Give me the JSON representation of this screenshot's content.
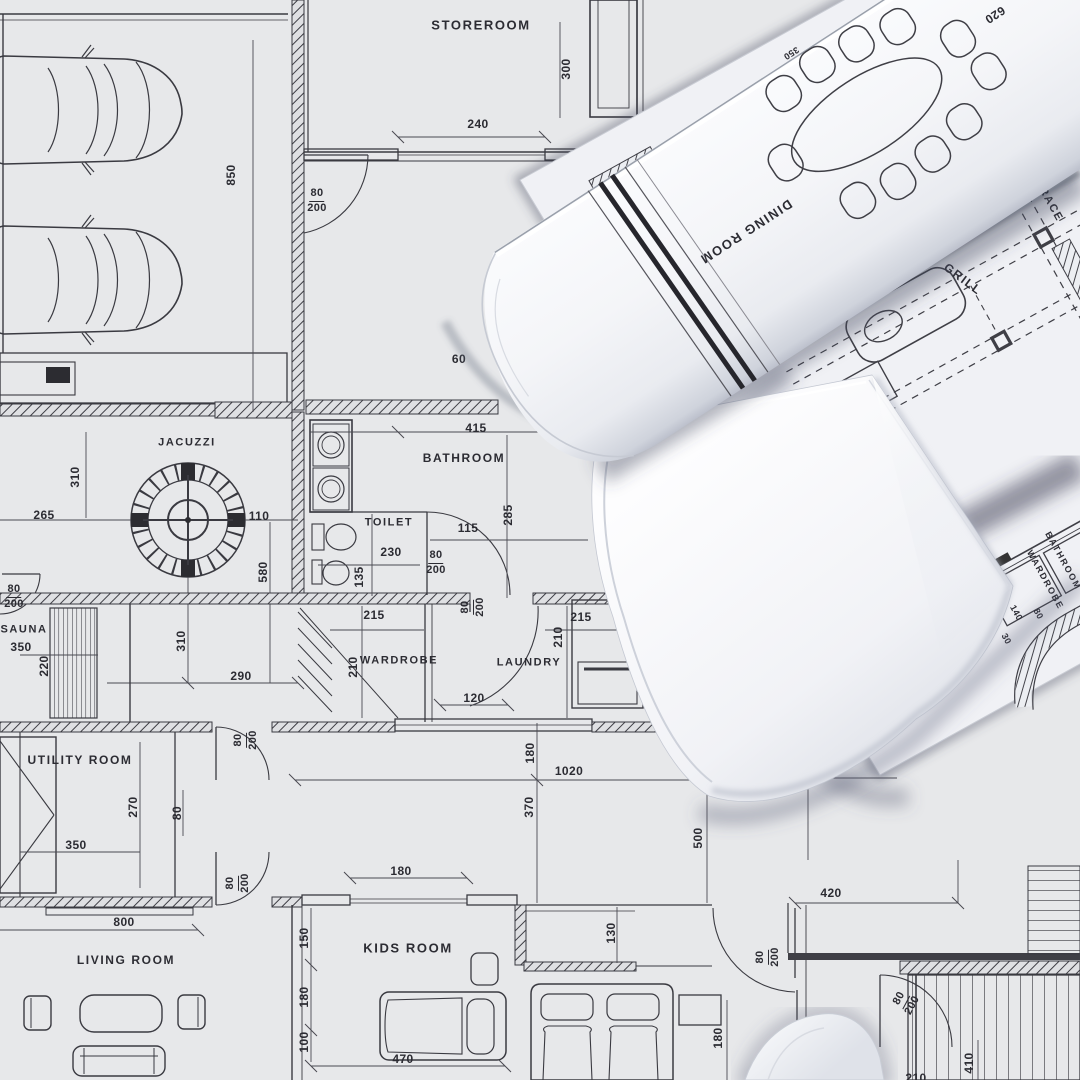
{
  "scene": {
    "description": "Architectural floor plan blueprint with rolled-up drawings lying on top",
    "palette": {
      "paper": "#e7e8ea",
      "roll_paper": "#f7f8fb",
      "ink": "#3a3a41",
      "dim_ink": "#44444b",
      "shadow": "#6b7088"
    }
  },
  "labels": [
    {
      "text": "STOREROOM",
      "kind": "room",
      "x": 481,
      "y": 25,
      "rot": 0,
      "size": 13,
      "layer": "base"
    },
    {
      "text": "JACUZZI",
      "kind": "room",
      "x": 187,
      "y": 443,
      "rot": 0,
      "size": 11,
      "layer": "base"
    },
    {
      "text": "BATHROOM",
      "kind": "room",
      "x": 464,
      "y": 458,
      "rot": 0,
      "size": 12,
      "layer": "base"
    },
    {
      "text": "TOILET",
      "kind": "room",
      "x": 389,
      "y": 523,
      "rot": 0,
      "size": 11,
      "layer": "base"
    },
    {
      "text": "SAUNA",
      "kind": "room",
      "x": 24,
      "y": 630,
      "rot": 0,
      "size": 11,
      "layer": "base"
    },
    {
      "text": "WARDROBE",
      "kind": "room",
      "x": 399,
      "y": 661,
      "rot": 0,
      "size": 11,
      "layer": "base"
    },
    {
      "text": "LAUNDRY",
      "kind": "room",
      "x": 529,
      "y": 663,
      "rot": 0,
      "size": 11,
      "layer": "base"
    },
    {
      "text": "UTILITY ROOM",
      "kind": "room",
      "x": 80,
      "y": 760,
      "rot": 0,
      "size": 12,
      "layer": "base"
    },
    {
      "text": "KIDS ROOM",
      "kind": "room",
      "x": 408,
      "y": 948,
      "rot": 0,
      "size": 13,
      "layer": "base"
    },
    {
      "text": "LIVING ROOM",
      "kind": "room",
      "x": 126,
      "y": 960,
      "rot": 0,
      "size": 12,
      "layer": "base"
    },
    {
      "text": "DINING ROOM",
      "kind": "room",
      "x": 746,
      "y": 232,
      "rot": 147,
      "size": 13,
      "layer": "roll"
    },
    {
      "text": "TERRACE",
      "kind": "room",
      "x": 1044,
      "y": 193,
      "rot": 61,
      "size": 11,
      "layer": "sheet2"
    },
    {
      "text": "GRILL",
      "kind": "room",
      "x": 963,
      "y": 279,
      "rot": 37,
      "size": 12,
      "layer": "sheet2"
    },
    {
      "text": "BATHROOM",
      "kind": "room",
      "x": 1063,
      "y": 561,
      "rot": 61,
      "size": 9,
      "layer": "sheet2"
    },
    {
      "text": "WARDROBE",
      "kind": "room",
      "x": 1045,
      "y": 580,
      "rot": 61,
      "size": 9,
      "layer": "sheet2"
    },
    {
      "text": "850",
      "kind": "dim",
      "x": 231,
      "y": 175,
      "rot": -90,
      "size": 12,
      "layer": "base"
    },
    {
      "text": "300",
      "kind": "dim",
      "x": 566,
      "y": 69,
      "rot": -90,
      "size": 12,
      "layer": "base"
    },
    {
      "text": "240",
      "kind": "dim",
      "x": 478,
      "y": 124,
      "rot": 0,
      "size": 12,
      "layer": "base"
    },
    {
      "text": "265",
      "kind": "dim",
      "x": 44,
      "y": 515,
      "rot": 0,
      "size": 12,
      "layer": "base"
    },
    {
      "text": "310",
      "kind": "dim",
      "x": 75,
      "y": 477,
      "rot": -90,
      "size": 12,
      "layer": "base"
    },
    {
      "text": "110",
      "kind": "dim",
      "x": 259,
      "y": 516,
      "rot": 0,
      "size": 12,
      "layer": "base"
    },
    {
      "text": "580",
      "kind": "dim",
      "x": 263,
      "y": 572,
      "rot": -90,
      "size": 12,
      "layer": "base"
    },
    {
      "text": "350",
      "kind": "dim",
      "x": 21,
      "y": 647,
      "rot": 0,
      "size": 12,
      "layer": "base"
    },
    {
      "text": "220",
      "kind": "dim",
      "x": 44,
      "y": 666,
      "rot": -90,
      "size": 12,
      "layer": "base"
    },
    {
      "text": "310",
      "kind": "dim",
      "x": 181,
      "y": 641,
      "rot": -90,
      "size": 12,
      "layer": "base"
    },
    {
      "text": "290",
      "kind": "dim",
      "x": 241,
      "y": 676,
      "rot": 0,
      "size": 12,
      "layer": "base"
    },
    {
      "text": "415",
      "kind": "dim",
      "x": 476,
      "y": 428,
      "rot": 0,
      "size": 12,
      "layer": "base"
    },
    {
      "text": "115",
      "kind": "dim",
      "x": 468,
      "y": 528,
      "rot": 0,
      "size": 12,
      "layer": "base"
    },
    {
      "text": "285",
      "kind": "dim",
      "x": 508,
      "y": 515,
      "rot": -90,
      "size": 12,
      "layer": "base"
    },
    {
      "text": "230",
      "kind": "dim",
      "x": 391,
      "y": 552,
      "rot": 0,
      "size": 12,
      "layer": "base"
    },
    {
      "text": "135",
      "kind": "dim",
      "x": 359,
      "y": 577,
      "rot": -90,
      "size": 12,
      "layer": "base"
    },
    {
      "text": "215",
      "kind": "dim",
      "x": 374,
      "y": 615,
      "rot": 0,
      "size": 12,
      "layer": "base"
    },
    {
      "text": "215",
      "kind": "dim",
      "x": 581,
      "y": 617,
      "rot": 0,
      "size": 12,
      "layer": "base"
    },
    {
      "text": "210",
      "kind": "dim",
      "x": 353,
      "y": 667,
      "rot": -90,
      "size": 12,
      "layer": "base"
    },
    {
      "text": "210",
      "kind": "dim",
      "x": 558,
      "y": 637,
      "rot": -90,
      "size": 12,
      "layer": "base"
    },
    {
      "text": "120",
      "kind": "dim",
      "x": 474,
      "y": 698,
      "rot": 0,
      "size": 12,
      "layer": "base"
    },
    {
      "text": "580",
      "kind": "dim",
      "x": 715,
      "y": 550,
      "rot": -90,
      "size": 12,
      "layer": "base"
    },
    {
      "text": "620",
      "kind": "dim",
      "x": 824,
      "y": 561,
      "rot": 0,
      "size": 12,
      "layer": "base"
    },
    {
      "text": "530",
      "kind": "dim",
      "x": 828,
      "y": 613,
      "rot": 0,
      "size": 12,
      "layer": "base"
    },
    {
      "text": "415",
      "kind": "dim",
      "x": 836,
      "y": 733,
      "rot": 0,
      "size": 12,
      "layer": "base"
    },
    {
      "text": "1020",
      "kind": "dim",
      "x": 569,
      "y": 771,
      "rot": 0,
      "size": 12,
      "layer": "base"
    },
    {
      "text": "180",
      "kind": "dim",
      "x": 530,
      "y": 753,
      "rot": -90,
      "size": 12,
      "layer": "base"
    },
    {
      "text": "370",
      "kind": "dim",
      "x": 529,
      "y": 807,
      "rot": -90,
      "size": 12,
      "layer": "base"
    },
    {
      "text": "500",
      "kind": "dim",
      "x": 698,
      "y": 838,
      "rot": -90,
      "size": 12,
      "layer": "base"
    },
    {
      "text": "270",
      "kind": "dim",
      "x": 133,
      "y": 807,
      "rot": -90,
      "size": 12,
      "layer": "base"
    },
    {
      "text": "80",
      "kind": "dim",
      "x": 177,
      "y": 813,
      "rot": -90,
      "size": 12,
      "layer": "base"
    },
    {
      "text": "350",
      "kind": "dim",
      "x": 76,
      "y": 845,
      "rot": 0,
      "size": 12,
      "layer": "base"
    },
    {
      "text": "800",
      "kind": "dim",
      "x": 124,
      "y": 922,
      "rot": 0,
      "size": 12,
      "layer": "base"
    },
    {
      "text": "180",
      "kind": "dim",
      "x": 401,
      "y": 871,
      "rot": 0,
      "size": 12,
      "layer": "base"
    },
    {
      "text": "150",
      "kind": "dim",
      "x": 304,
      "y": 938,
      "rot": -90,
      "size": 12,
      "layer": "base"
    },
    {
      "text": "180",
      "kind": "dim",
      "x": 304,
      "y": 997,
      "rot": -90,
      "size": 12,
      "layer": "base"
    },
    {
      "text": "100",
      "kind": "dim",
      "x": 304,
      "y": 1042,
      "rot": -90,
      "size": 12,
      "layer": "base"
    },
    {
      "text": "470",
      "kind": "dim",
      "x": 403,
      "y": 1059,
      "rot": 0,
      "size": 12,
      "layer": "base"
    },
    {
      "text": "130",
      "kind": "dim",
      "x": 611,
      "y": 933,
      "rot": -90,
      "size": 12,
      "layer": "base"
    },
    {
      "text": "180",
      "kind": "dim",
      "x": 718,
      "y": 1038,
      "rot": -90,
      "size": 12,
      "layer": "base"
    },
    {
      "text": "420",
      "kind": "dim",
      "x": 831,
      "y": 893,
      "rot": 0,
      "size": 12,
      "layer": "base"
    },
    {
      "text": "410",
      "kind": "dim",
      "x": 969,
      "y": 1063,
      "rot": -90,
      "size": 12,
      "layer": "base"
    },
    {
      "text": "210",
      "kind": "dim",
      "x": 916,
      "y": 1078,
      "rot": 0,
      "size": 12,
      "layer": "base"
    },
    {
      "text": "60",
      "kind": "dim",
      "x": 459,
      "y": 359,
      "rot": 0,
      "size": 12,
      "layer": "base"
    },
    {
      "text": "D",
      "kind": "note",
      "x": 789,
      "y": 37,
      "rot": 0,
      "size": 13,
      "layer": "base"
    },
    {
      "text": "620",
      "kind": "dim",
      "x": 995,
      "y": 15,
      "rot": 147,
      "size": 12,
      "layer": "roll"
    },
    {
      "text": "350",
      "kind": "dim",
      "x": 791,
      "y": 53,
      "rot": 147,
      "size": 9,
      "layer": "roll"
    },
    {
      "text": "140",
      "kind": "dim",
      "x": 1016,
      "y": 613,
      "rot": 61,
      "size": 9,
      "layer": "sheet2"
    },
    {
      "text": "80",
      "kind": "dim",
      "x": 1038,
      "y": 614,
      "rot": 61,
      "size": 9,
      "layer": "sheet2"
    },
    {
      "text": "30",
      "kind": "dim",
      "x": 1006,
      "y": 639,
      "rot": 61,
      "size": 9,
      "layer": "sheet2"
    },
    {
      "text": "80/200",
      "kind": "frac",
      "x": 317,
      "y": 201,
      "rot": 0,
      "size": 11,
      "layer": "base"
    },
    {
      "text": "80/200",
      "kind": "frac",
      "x": 14,
      "y": 597,
      "rot": 0,
      "size": 11,
      "layer": "base"
    },
    {
      "text": "80/200",
      "kind": "frac",
      "x": 436,
      "y": 563,
      "rot": 0,
      "size": 11,
      "layer": "base"
    },
    {
      "text": "80/200",
      "kind": "frac",
      "x": 473,
      "y": 607,
      "rot": -90,
      "size": 11,
      "layer": "base"
    },
    {
      "text": "80/200",
      "kind": "frac",
      "x": 246,
      "y": 740,
      "rot": -90,
      "size": 11,
      "layer": "base"
    },
    {
      "text": "80/200",
      "kind": "frac",
      "x": 238,
      "y": 883,
      "rot": -90,
      "size": 11,
      "layer": "base"
    },
    {
      "text": "80/200",
      "kind": "frac",
      "x": 768,
      "y": 957,
      "rot": -90,
      "size": 11,
      "layer": "base"
    },
    {
      "text": "80/200",
      "kind": "frac",
      "x": 906,
      "y": 1002,
      "rot": -62,
      "size": 11,
      "layer": "base"
    }
  ]
}
